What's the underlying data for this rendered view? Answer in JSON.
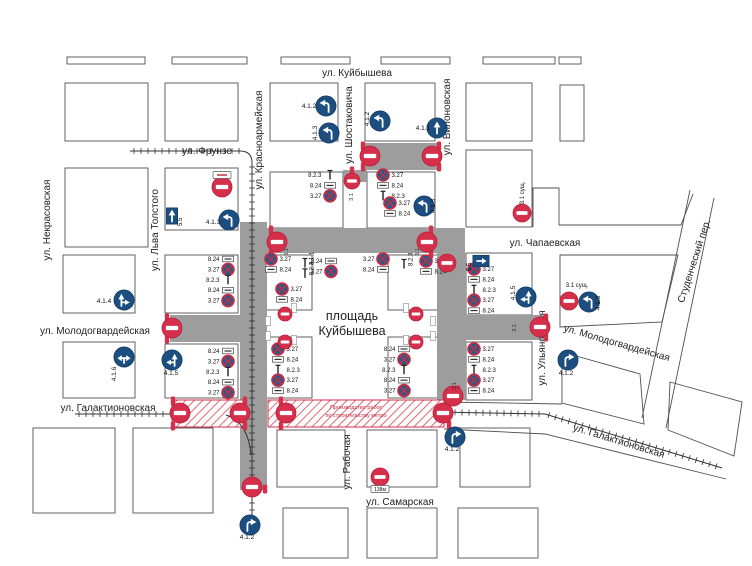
{
  "title": {
    "line1": "3. Репетиция парада без техники:",
    "line2": "с 16 часов 00 минут до 23 часов 00 минут 2 мая 2025 г."
  },
  "map": {
    "background": "#ffffff",
    "road_closed_color": "#9d9d9d",
    "no_entry_color": "#d62f4b",
    "mandatory_sign_color": "#1d4e80",
    "square": {
      "line1": "площадь",
      "line2": "Куйбышева",
      "x": 352,
      "y": 320
    },
    "construction": {
      "line1": "Производство работ",
      "line2": "по строительству метро",
      "x": 356,
      "y": 409,
      "rects": [
        [
          172,
          400,
          71,
          27
        ],
        [
          268,
          400,
          176,
          27
        ]
      ]
    },
    "streets_h": [
      {
        "name": "ул. Куйбышева",
        "x": 357,
        "y": 76
      },
      {
        "name": "ул. Фрунзе",
        "x": 207,
        "y": 154
      },
      {
        "name": "ул. Чапаевская",
        "x": 545,
        "y": 246
      },
      {
        "name": "ул. Молодогвардейская",
        "x": 95,
        "y": 334
      },
      {
        "name": "ул. Галактионовская",
        "x": 108,
        "y": 411
      },
      {
        "name": "ул. Самарская",
        "x": 400,
        "y": 505
      }
    ],
    "streets_v": [
      {
        "name": "ул. Некрасовская",
        "x": 50,
        "y": 220
      },
      {
        "name": "ул. Льва Толстого",
        "x": 158,
        "y": 230
      },
      {
        "name": "ул. Красноармейская",
        "x": 262,
        "y": 140
      },
      {
        "name": "ул. Шостаковича",
        "x": 352,
        "y": 125
      },
      {
        "name": "ул. Вилоновская",
        "x": 450,
        "y": 117
      },
      {
        "name": "ул. Ульяновская",
        "x": 545,
        "y": 348
      },
      {
        "name": "ул. Рабочая",
        "x": 350,
        "y": 462
      }
    ],
    "streets_d": [
      {
        "name": "Студенческий пер.",
        "x": 697,
        "y": 262,
        "rot": -72
      },
      {
        "name": "ул. Молодогвардейская",
        "x": 616,
        "y": 346,
        "rot": 16
      },
      {
        "name": "ул. Галактионовская",
        "x": 618,
        "y": 444,
        "rot": 17
      }
    ],
    "blocks": [
      [
        67,
        57,
        78,
        7
      ],
      [
        172,
        57,
        75,
        7
      ],
      [
        281,
        57,
        69,
        7
      ],
      [
        381,
        57,
        69,
        7
      ],
      [
        483,
        57,
        72,
        7
      ],
      [
        559,
        57,
        22,
        7
      ],
      [
        65,
        83,
        83,
        58
      ],
      [
        165,
        83,
        73,
        58
      ],
      [
        270,
        83,
        68,
        58
      ],
      [
        365,
        83,
        70,
        58
      ],
      [
        466,
        83,
        66,
        58
      ],
      [
        560,
        85,
        24,
        56
      ],
      [
        65,
        168,
        83,
        79
      ],
      [
        165,
        168,
        73,
        62
      ],
      [
        270,
        172,
        73,
        56
      ],
      [
        367,
        172,
        68,
        56
      ],
      [
        466,
        150,
        66,
        77
      ],
      [
        63,
        255,
        72,
        58
      ],
      [
        165,
        255,
        73,
        58
      ],
      [
        265,
        255,
        47,
        55
      ],
      [
        388,
        255,
        50,
        55
      ],
      [
        466,
        253,
        66,
        62
      ],
      [
        63,
        342,
        72,
        56
      ],
      [
        165,
        344,
        73,
        54
      ],
      [
        265,
        337,
        47,
        61
      ],
      [
        388,
        337,
        50,
        61
      ],
      [
        466,
        342,
        66,
        58
      ],
      [
        33,
        428,
        82,
        85
      ],
      [
        133,
        428,
        80,
        85
      ],
      [
        277,
        430,
        68,
        57
      ],
      [
        367,
        430,
        70,
        57
      ],
      [
        460,
        428,
        70,
        59
      ],
      [
        283,
        508,
        65,
        50
      ],
      [
        367,
        508,
        70,
        50
      ],
      [
        458,
        508,
        80,
        50
      ]
    ],
    "outlines": [
      {
        "type": "polyline",
        "points": "533,227 533,188 559,188 559,225 681,225 693,194"
      },
      {
        "type": "polygon",
        "points": "560,255 678,255 662,322 560,327"
      },
      {
        "type": "polygon",
        "points": "562,352 640,374 644,424 562,403"
      },
      {
        "type": "polygon",
        "points": "670,382 742,402 734,456 668,430"
      },
      {
        "type": "polyline",
        "points": "690,190 642,418"
      },
      {
        "type": "polyline",
        "points": "714,198 666,428"
      },
      {
        "type": "polyline",
        "points": "444,429 545,434 726,479"
      },
      {
        "type": "polyline",
        "points": "444,402 562,404"
      }
    ],
    "gray_roads": [
      [
        240,
        222,
        27,
        268
      ],
      [
        240,
        228,
        225,
        25
      ],
      [
        437,
        253,
        29,
        147
      ],
      [
        170,
        315,
        70,
        27
      ],
      [
        466,
        315,
        79,
        25
      ],
      [
        365,
        143,
        72,
        27
      ],
      [
        343,
        170,
        24,
        12
      ]
    ],
    "railways": {
      "lines": [
        [
          130,
          151,
          240,
          151
        ],
        [
          252,
          163,
          252,
          533
        ],
        [
          75,
          414,
          170,
          414
        ],
        [
          437,
          412,
          545,
          414
        ],
        [
          545,
          414,
          722,
          468
        ]
      ],
      "curves": [
        "M240,151 Q252,151 252,163",
        "M226,415 Q248,422 251,455"
      ]
    },
    "no_entry_signs": [
      [
        222,
        187,
        10
      ],
      [
        370,
        156,
        10
      ],
      [
        432,
        156,
        10
      ],
      [
        352,
        181,
        8
      ],
      [
        277,
        242,
        10
      ],
      [
        427,
        242,
        10
      ],
      [
        172,
        328,
        10
      ],
      [
        540,
        327,
        10
      ],
      [
        522,
        213,
        9
      ],
      [
        569,
        301,
        9
      ],
      [
        447,
        263,
        9
      ],
      [
        453,
        396,
        10
      ],
      [
        180,
        413,
        10
      ],
      [
        240,
        413,
        10
      ],
      [
        286,
        413,
        10
      ],
      [
        443,
        413,
        10
      ],
      [
        252,
        487,
        10
      ],
      [
        380,
        477,
        9
      ],
      [
        285,
        314,
        7
      ],
      [
        285,
        342,
        7
      ],
      [
        416,
        314,
        7
      ],
      [
        416,
        342,
        7
      ]
    ],
    "sign_3_1_labels": [
      {
        "text": "3.1",
        "x": 353,
        "y": 197,
        "rot": 1
      },
      {
        "text": "3.1",
        "x": 288,
        "y": 252,
        "rot": 1
      },
      {
        "text": "3.1",
        "x": 419,
        "y": 252,
        "rot": 1
      },
      {
        "text": "3.1",
        "x": 516,
        "y": 328,
        "rot": 1
      },
      {
        "text": "3.1",
        "x": 456,
        "y": 386,
        "rot": 1
      }
    ],
    "sign_3_1_existing": [
      {
        "text": "3.1 сущ.",
        "x": 524,
        "y": 193,
        "rot": 1
      },
      {
        "text": "3.1 сущ.",
        "x": 577,
        "y": 287,
        "rot": 0
      }
    ],
    "blue_signs": [
      {
        "x": 326,
        "y": 106,
        "arrow": "tl",
        "label": "4.1.2",
        "lx": 309,
        "ly": 108,
        "lrot": 0
      },
      {
        "x": 329,
        "y": 133,
        "arrow": "tl",
        "label": "4.1.3",
        "lx": 317,
        "ly": 133,
        "lrot": 1
      },
      {
        "x": 380,
        "y": 121,
        "arrow": "tl",
        "label": "4.1.2",
        "lx": 369,
        "ly": 119,
        "lrot": 1
      },
      {
        "x": 437,
        "y": 128,
        "arrow": "up",
        "label": "4.1.1",
        "lx": 423,
        "ly": 130,
        "lrot": 0
      },
      {
        "x": 229,
        "y": 220,
        "arrow": "tl",
        "label": "4.1.3",
        "lx": 213,
        "ly": 224,
        "lrot": 0
      },
      {
        "x": 424,
        "y": 206,
        "arrow": "tl",
        "label": "4.1.3",
        "lx": 435,
        "ly": 206,
        "lrot": 1
      },
      {
        "x": 124,
        "y": 300,
        "arrow": "ur",
        "label": "4.1.4",
        "lx": 104,
        "ly": 303,
        "lrot": 0
      },
      {
        "x": 172,
        "y": 360,
        "arrow": "ul",
        "label": "4.1.5",
        "lx": 171,
        "ly": 375,
        "lrot": 0
      },
      {
        "x": 124,
        "y": 357,
        "arrow": "lr",
        "label": "4.1.6",
        "lx": 116,
        "ly": 374,
        "lrot": 1
      },
      {
        "x": 526,
        "y": 297,
        "arrow": "ul",
        "label": "4.1.5",
        "lx": 515,
        "ly": 293,
        "lrot": 1
      },
      {
        "x": 589,
        "y": 302,
        "arrow": "tl",
        "label": "4.1.3",
        "lx": 600,
        "ly": 303,
        "lrot": 1
      },
      {
        "x": 568,
        "y": 360,
        "arrow": "tr",
        "label": "4.1.2",
        "lx": 566,
        "ly": 375,
        "lrot": 0
      },
      {
        "x": 455,
        "y": 437,
        "arrow": "tr",
        "label": "4.1.2",
        "lx": 452,
        "ly": 451,
        "lrot": 0
      },
      {
        "x": 250,
        "y": 525,
        "arrow": "tr",
        "label": "4.1.2",
        "lx": 247,
        "ly": 539,
        "lrot": 0
      }
    ],
    "blue_rect_signs": [
      {
        "x": 172,
        "y": 216,
        "arrow": "up",
        "label": "5.5",
        "lx": 182,
        "ly": 222,
        "lrot": 1
      },
      {
        "x": 481,
        "y": 261,
        "arrow": "right",
        "label": "5.5",
        "lx": 471,
        "ly": 267,
        "lrot": 1
      }
    ],
    "sign_clusters": [
      {
        "x": 228,
        "y": 259,
        "m": 1,
        "rot": 0,
        "rows": [
          [
            "p",
            "8.24"
          ],
          [
            "c",
            "3.27"
          ],
          [
            "t",
            "8.2.3"
          ],
          [
            "p",
            "8.24"
          ],
          [
            "c",
            "3.27"
          ]
        ]
      },
      {
        "x": 228,
        "y": 351,
        "m": 1,
        "rot": 0,
        "rows": [
          [
            "p",
            "8.24"
          ],
          [
            "c",
            "3.27"
          ],
          [
            "t",
            "8.2.3"
          ],
          [
            "p",
            "8.24"
          ],
          [
            "c",
            "3.27"
          ]
        ]
      },
      {
        "x": 330,
        "y": 175,
        "m": 1,
        "rot": 0,
        "rows": [
          [
            "t",
            "8.2.3"
          ],
          [
            "p",
            "8.24"
          ],
          [
            "c",
            "3.27"
          ]
        ]
      },
      {
        "x": 383,
        "y": 175,
        "m": 0,
        "rot": 0,
        "rows": [
          [
            "c",
            "3.27"
          ],
          [
            "p",
            "8.24"
          ],
          [
            "t",
            "8.2.3"
          ]
        ]
      },
      {
        "x": 390,
        "y": 203,
        "m": 0,
        "rot": 0,
        "rows": [
          [
            "c",
            "3.27"
          ],
          [
            "p",
            "8.24"
          ]
        ]
      },
      {
        "x": 474,
        "y": 269,
        "m": 0,
        "rot": 0,
        "rows": [
          [
            "c",
            "3.27"
          ],
          [
            "p",
            "8.24"
          ],
          [
            "t",
            "8.2.3"
          ],
          [
            "c",
            "3.27"
          ],
          [
            "p",
            "8.24"
          ]
        ]
      },
      {
        "x": 474,
        "y": 349,
        "m": 0,
        "rot": 0,
        "rows": [
          [
            "c",
            "3.27"
          ],
          [
            "p",
            "8.24"
          ],
          [
            "t",
            "8.2.3"
          ],
          [
            "c",
            "3.27"
          ],
          [
            "p",
            "8.24"
          ]
        ]
      },
      {
        "x": 271,
        "y": 259,
        "m": 0,
        "rot": 0,
        "rows": [
          [
            "c",
            "3.27"
          ],
          [
            "p",
            "8.24"
          ]
        ]
      },
      {
        "x": 282,
        "y": 289,
        "m": 0,
        "rot": 0,
        "rows": [
          [
            "c",
            "3.27"
          ],
          [
            "p",
            "8.24"
          ]
        ]
      },
      {
        "x": 305,
        "y": 263,
        "m": 0,
        "rot": 1,
        "rows": [
          [
            "t",
            "4.1.1"
          ],
          [
            "t",
            "8.2.3"
          ]
        ]
      },
      {
        "x": 331,
        "y": 261,
        "m": 1,
        "rot": 0,
        "rows": [
          [
            "p",
            "8.24"
          ],
          [
            "c",
            "3.27"
          ]
        ]
      },
      {
        "x": 383,
        "y": 259,
        "m": 1,
        "rot": 0,
        "rows": [
          [
            "c",
            "3.27"
          ],
          [
            "p",
            "8.24"
          ]
        ]
      },
      {
        "x": 404,
        "y": 264,
        "m": 0,
        "rot": 1,
        "rows": [
          [
            "t",
            "8.2.3"
          ]
        ]
      },
      {
        "x": 426,
        "y": 261,
        "m": 0,
        "rot": 0,
        "rows": [
          [
            "c",
            "3.27"
          ],
          [
            "p",
            "8.24"
          ]
        ]
      },
      {
        "x": 278,
        "y": 349,
        "m": 0,
        "rot": 0,
        "rows": [
          [
            "c",
            "3.27"
          ],
          [
            "p",
            "8.24"
          ],
          [
            "t",
            "8.2.3"
          ],
          [
            "c",
            "3.27"
          ],
          [
            "p",
            "8.24"
          ]
        ]
      },
      {
        "x": 404,
        "y": 349,
        "m": 1,
        "rot": 0,
        "rows": [
          [
            "p",
            "8.24"
          ],
          [
            "c",
            "3.27"
          ],
          [
            "t",
            "8.2.3"
          ],
          [
            "p",
            "8.24"
          ],
          [
            "c",
            "3.27"
          ]
        ]
      }
    ],
    "red_posts": [
      [
        167,
        318
      ],
      [
        167,
        339
      ],
      [
        363,
        146
      ],
      [
        439,
        146
      ],
      [
        363,
        167
      ],
      [
        439,
        167
      ],
      [
        271,
        230
      ],
      [
        271,
        254
      ],
      [
        431,
        230
      ],
      [
        431,
        254
      ],
      [
        546,
        318
      ],
      [
        546,
        337
      ],
      [
        449,
        401
      ],
      [
        449,
        425
      ],
      [
        173,
        401
      ],
      [
        173,
        426
      ],
      [
        245,
        401
      ],
      [
        245,
        426
      ],
      [
        281,
        401
      ],
      [
        281,
        426
      ],
      [
        265,
        489
      ],
      [
        458,
        390
      ],
      [
        352,
        171
      ]
    ],
    "plates": [
      {
        "x": 380,
        "y": 489,
        "w": 18,
        "h": 7,
        "text": "138м"
      },
      {
        "x": 222,
        "y": 175,
        "w": 18,
        "h": 7,
        "text": ""
      }
    ],
    "micro_plates": [
      [
        294,
        308
      ],
      [
        294,
        340
      ],
      [
        406,
        308
      ],
      [
        406,
        340
      ],
      [
        268,
        321
      ],
      [
        268,
        336
      ],
      [
        433,
        321
      ],
      [
        433,
        336
      ]
    ]
  }
}
